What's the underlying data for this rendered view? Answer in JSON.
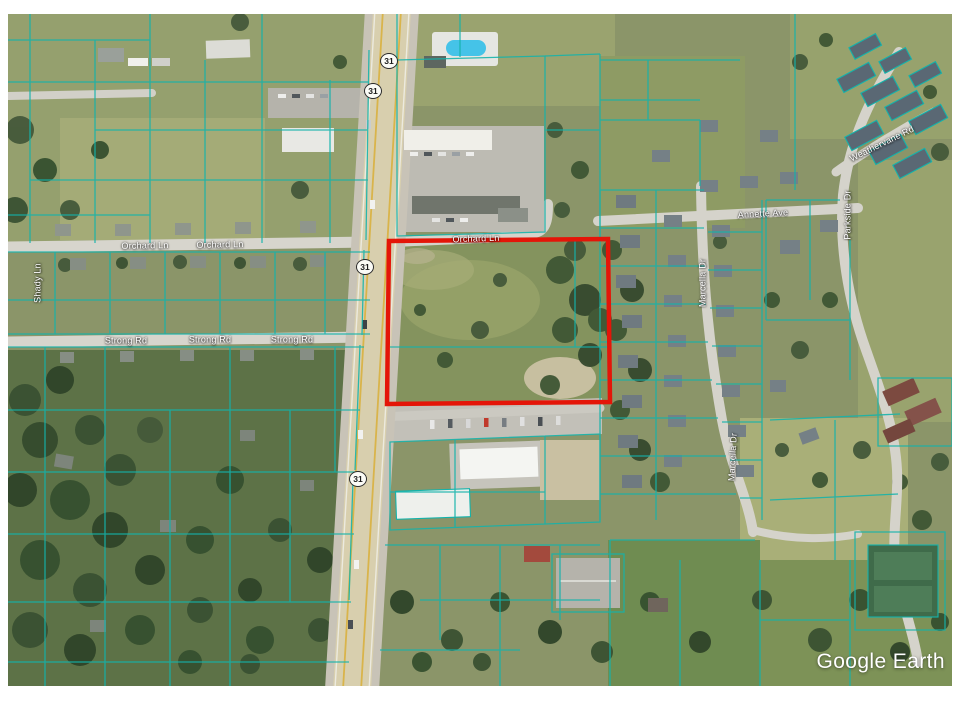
{
  "app": {
    "watermark": "Google Earth",
    "status_text": "Imagery Date: 5/30/2022      42°46'51\" N   86°07'09\" W   elev   0 ft      eye alt   3337 ft"
  },
  "map": {
    "highway": {
      "route_number": "31"
    },
    "roads": {
      "orchard_ln": "Orchard Ln",
      "strong_rd": "Strong Rd",
      "annette_ave": "Annette Ave",
      "weathervane_rd": "Weathervane Rd",
      "marcella_dr": "Marcella Dr",
      "parkside_dr": "Parkside Dr",
      "shady_ln": "Shady Ln"
    },
    "colors": {
      "parcel_line": "#14b3ab",
      "highlight_outline": "#e41508",
      "watermark": "#ffffff"
    }
  }
}
